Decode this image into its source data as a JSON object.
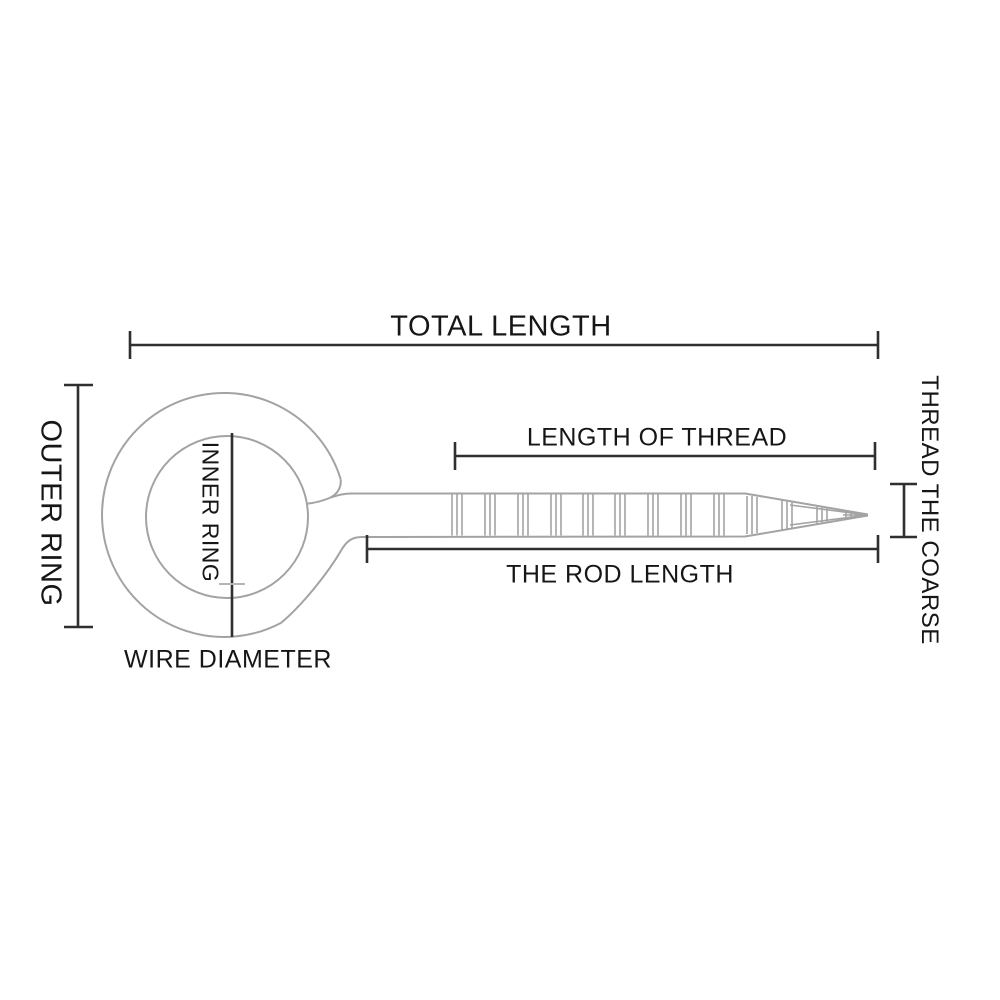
{
  "colors": {
    "background": "#ffffff",
    "outline": "#a3a3a3",
    "dimension": "#2f2f2f",
    "text": "#161616",
    "faint": "#b5b5b5"
  },
  "diagram": {
    "labels": {
      "total_length": "TOTAL LENGTH",
      "outer_ring": "OUTER RING",
      "inner_ring": "INNER RING",
      "wire_diameter": "WIRE DIAMETER",
      "length_of_thread": "LENGTH OF THREAD",
      "rod_length": "THE ROD LENGTH",
      "thread_coarse": "THREAD THE COARSE"
    }
  }
}
